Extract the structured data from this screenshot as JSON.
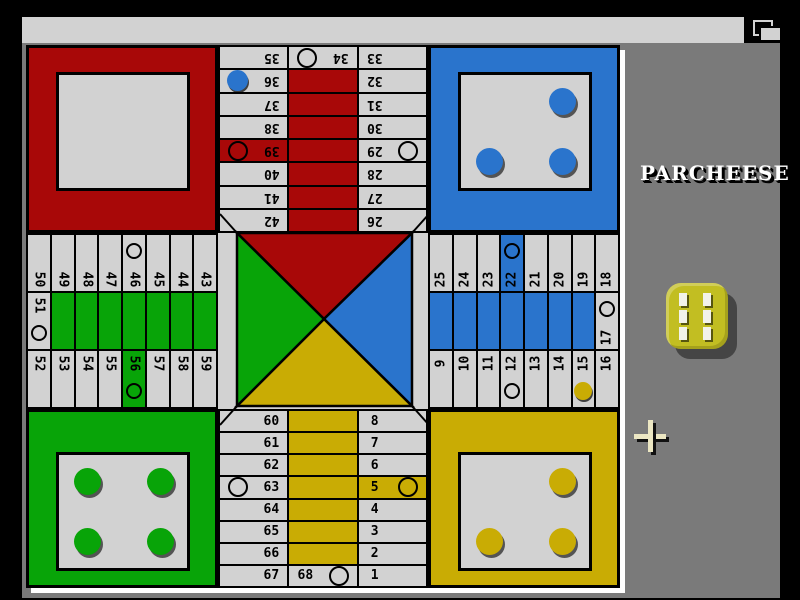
{
  "window": {
    "title": "PARCHEESE  (c) Xavier Egusquiza"
  },
  "side_panel": {
    "logo": "PARCHEESE",
    "die_value": 6
  },
  "colors": {
    "red": "#a80808",
    "blue": "#2a74cc",
    "green": "#08a408",
    "yellow": "#c9ac04",
    "die_yellow": "#c2be22",
    "cell_bg": "#d2d2d2",
    "titlebar_bg": "#d2d2d2",
    "panel_bg": "#7a7a7a",
    "screen_bg": "#000000",
    "board_frame": "#ffffff"
  },
  "board": {
    "track": {
      "top": {
        "left": [
          35,
          36,
          37,
          38,
          39,
          40,
          41,
          42
        ],
        "mid": 34,
        "right": [
          33,
          32,
          31,
          30,
          29,
          28,
          27,
          26
        ],
        "home_run_color": "red"
      },
      "bottom": {
        "left": [
          60,
          61,
          62,
          63,
          64,
          65,
          66,
          67
        ],
        "mid": 68,
        "right": [
          8,
          7,
          6,
          5,
          4,
          3,
          2,
          1
        ],
        "home_run_color": "yellow"
      },
      "left": {
        "top": [
          50,
          49,
          48,
          47,
          46,
          45,
          44,
          43
        ],
        "mid": 51,
        "bottom": [
          52,
          53,
          54,
          55,
          56,
          57,
          58,
          59
        ],
        "home_run_color": "green"
      },
      "right": {
        "top": [
          25,
          24,
          23,
          22,
          21,
          20,
          19,
          18
        ],
        "mid": 17,
        "bottom": [
          9,
          10,
          11,
          12,
          13,
          14,
          15,
          16
        ],
        "home_run_color": "blue"
      },
      "safe_circle_cells": [
        5,
        12,
        17,
        22,
        29,
        34,
        39,
        46,
        51,
        56,
        63,
        68
      ],
      "colored_cells": {
        "5": "yellow",
        "22": "blue",
        "39": "red",
        "56": "green"
      }
    },
    "pieces": {
      "on_track": [
        {
          "cell": 36,
          "color": "blue"
        },
        {
          "cell": 15,
          "color": "yellow"
        }
      ],
      "homes": {
        "red": [],
        "blue": [
          "tr",
          "bl",
          "br"
        ],
        "green": [
          "tl",
          "tr",
          "bl",
          "br"
        ],
        "yellow": [
          "tr",
          "bl",
          "br"
        ]
      }
    }
  }
}
